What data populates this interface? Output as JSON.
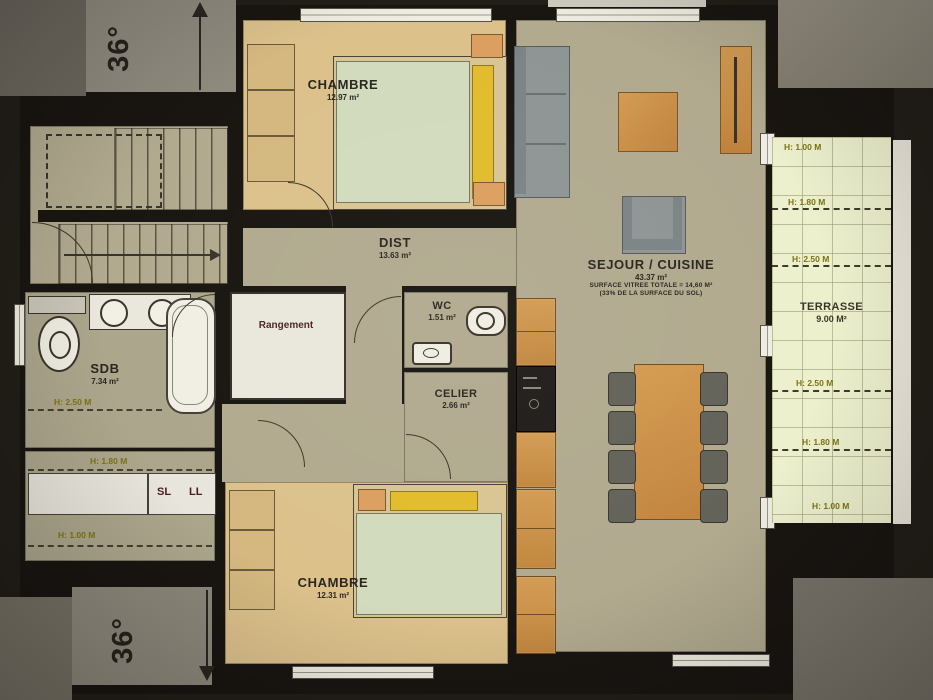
{
  "plan": {
    "slope_top": "36°",
    "slope_bottom": "36°",
    "rooms": {
      "chambre1": {
        "name": "CHAMBRE",
        "area": "12.97 m²"
      },
      "dist": {
        "name": "DIST",
        "area": "13.63 m²"
      },
      "sejour": {
        "name": "SEJOUR / CUISINE",
        "area": "43.37 m²",
        "note1": "SURFACE VITREE TOTALE = 14,60 M²",
        "note2": "(33% DE LA SURFACE DU SOL)"
      },
      "rangement": {
        "name": "Rangement"
      },
      "wc": {
        "name": "WC",
        "area": "1.51 m²"
      },
      "sdb": {
        "name": "SDB",
        "area": "7.34 m²"
      },
      "celier": {
        "name": "CELIER",
        "area": "2.66 m²"
      },
      "chambre2": {
        "name": "CHAMBRE",
        "area": "12.31 m²"
      },
      "terrasse": {
        "name": "TERRASSE",
        "area": "9.00 M²"
      }
    },
    "sdb_heights": {
      "h250": "H: 2.50 M",
      "h180": "H: 1.80 M",
      "h100": "H: 1.00 M"
    },
    "appliances": {
      "sl": "SL",
      "ll": "LL"
    },
    "terrace_heights": {
      "t1": "H: 1.00 M",
      "t2": "H: 1.80 M",
      "t3": "H: 2.50 M",
      "b3": "H: 2.50 M",
      "b2": "H: 1.80 M",
      "b1": "H: 1.00 M"
    },
    "colors": {
      "background": "#221e18",
      "wall": "#191511",
      "floor_olive": "#b1aa8f",
      "floor_bedroom": "#dcc18b",
      "terrace": "#edf0cd",
      "white_room": "#eae7dc",
      "wood_orange": "#cd9349",
      "sofa_gray": "#8e9594",
      "pillow_yellow": "#e2bc2c",
      "duvet_green": "#d2dbbd",
      "height_label": "#7d7316",
      "panel_gray": "#8f8a7e"
    }
  }
}
